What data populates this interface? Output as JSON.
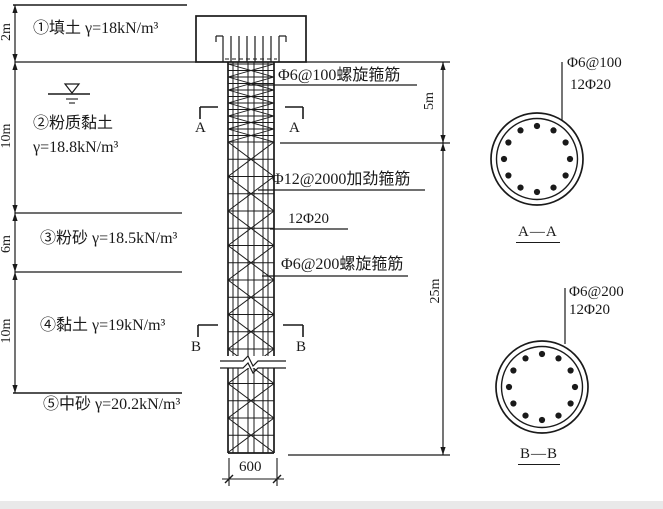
{
  "soil_profile": {
    "layers": [
      {
        "label": "①填土 γ=18kN/m³",
        "thickness": "2m"
      },
      {
        "label": "②粉质黏土",
        "label2": "γ=18.8kN/m³",
        "thickness": "10m"
      },
      {
        "label": "③粉砂 γ=18.5kN/m³",
        "thickness": "6m"
      },
      {
        "label": "④黏土 γ=19kN/m³",
        "thickness": "10m"
      },
      {
        "label": "⑤中砂 γ=20.2kN/m³",
        "thickness": ""
      }
    ]
  },
  "pile_elevation": {
    "annotations": [
      "Φ6@100螺旋箍筋",
      "Φ12@2000加劲箍筋",
      "12Φ20",
      "Φ6@200螺旋箍筋"
    ],
    "dimensions": {
      "upper_depth": "5m",
      "lower_depth": "25m",
      "pile_width": "600"
    },
    "section_marks": {
      "a": "A",
      "b": "B"
    }
  },
  "sections": [
    {
      "title": "A—A",
      "stirrup": "Φ6@100",
      "bars": "12Φ20"
    },
    {
      "title": "B—B",
      "stirrup": "Φ6@200",
      "bars": "12Φ20"
    }
  ]
}
